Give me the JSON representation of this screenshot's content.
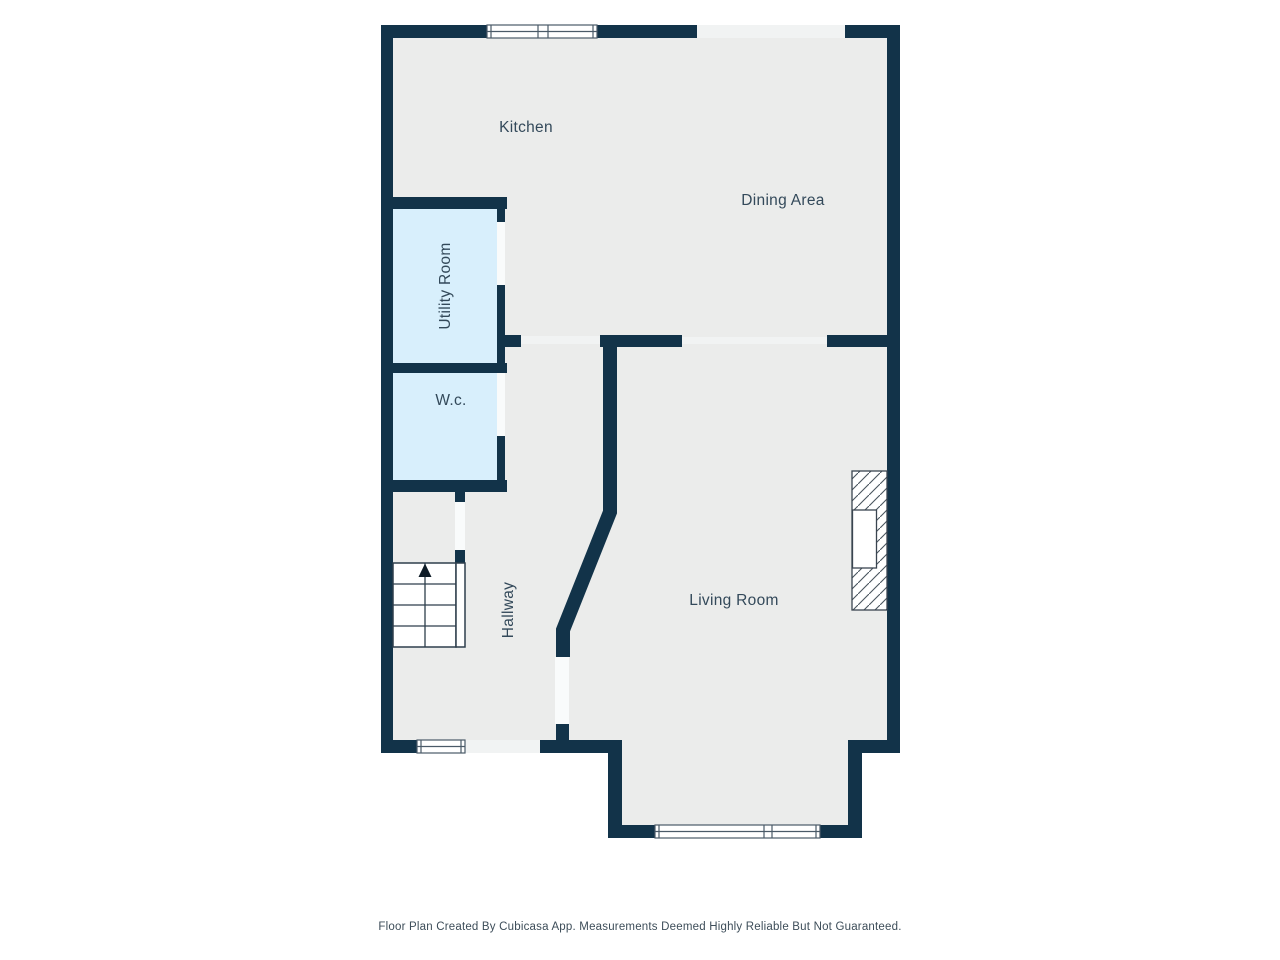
{
  "page": {
    "background": "#ffffff"
  },
  "colors": {
    "wall": "#123349",
    "floor": "#ebeceb",
    "wet-room": "#d8effc",
    "label": "#33495a",
    "frame": "#4a5a68",
    "opening": "#f1f3f3",
    "window-fill": "#ffffff",
    "stair-line": "#2e3e4c"
  },
  "rooms": {
    "kitchen": {
      "label": "Kitchen"
    },
    "dining": {
      "label": "Dining Area"
    },
    "utility": {
      "label": "Utility Room"
    },
    "wc": {
      "label": "W.c."
    },
    "hallway": {
      "label": "Hallway"
    },
    "living": {
      "label": "Living Room"
    }
  },
  "symbols": {
    "stairs_direction": "up"
  },
  "footer": {
    "disclaimer": "Floor Plan Created By Cubicasa App. Measurements Deemed Highly Reliable But Not Guaranteed."
  }
}
